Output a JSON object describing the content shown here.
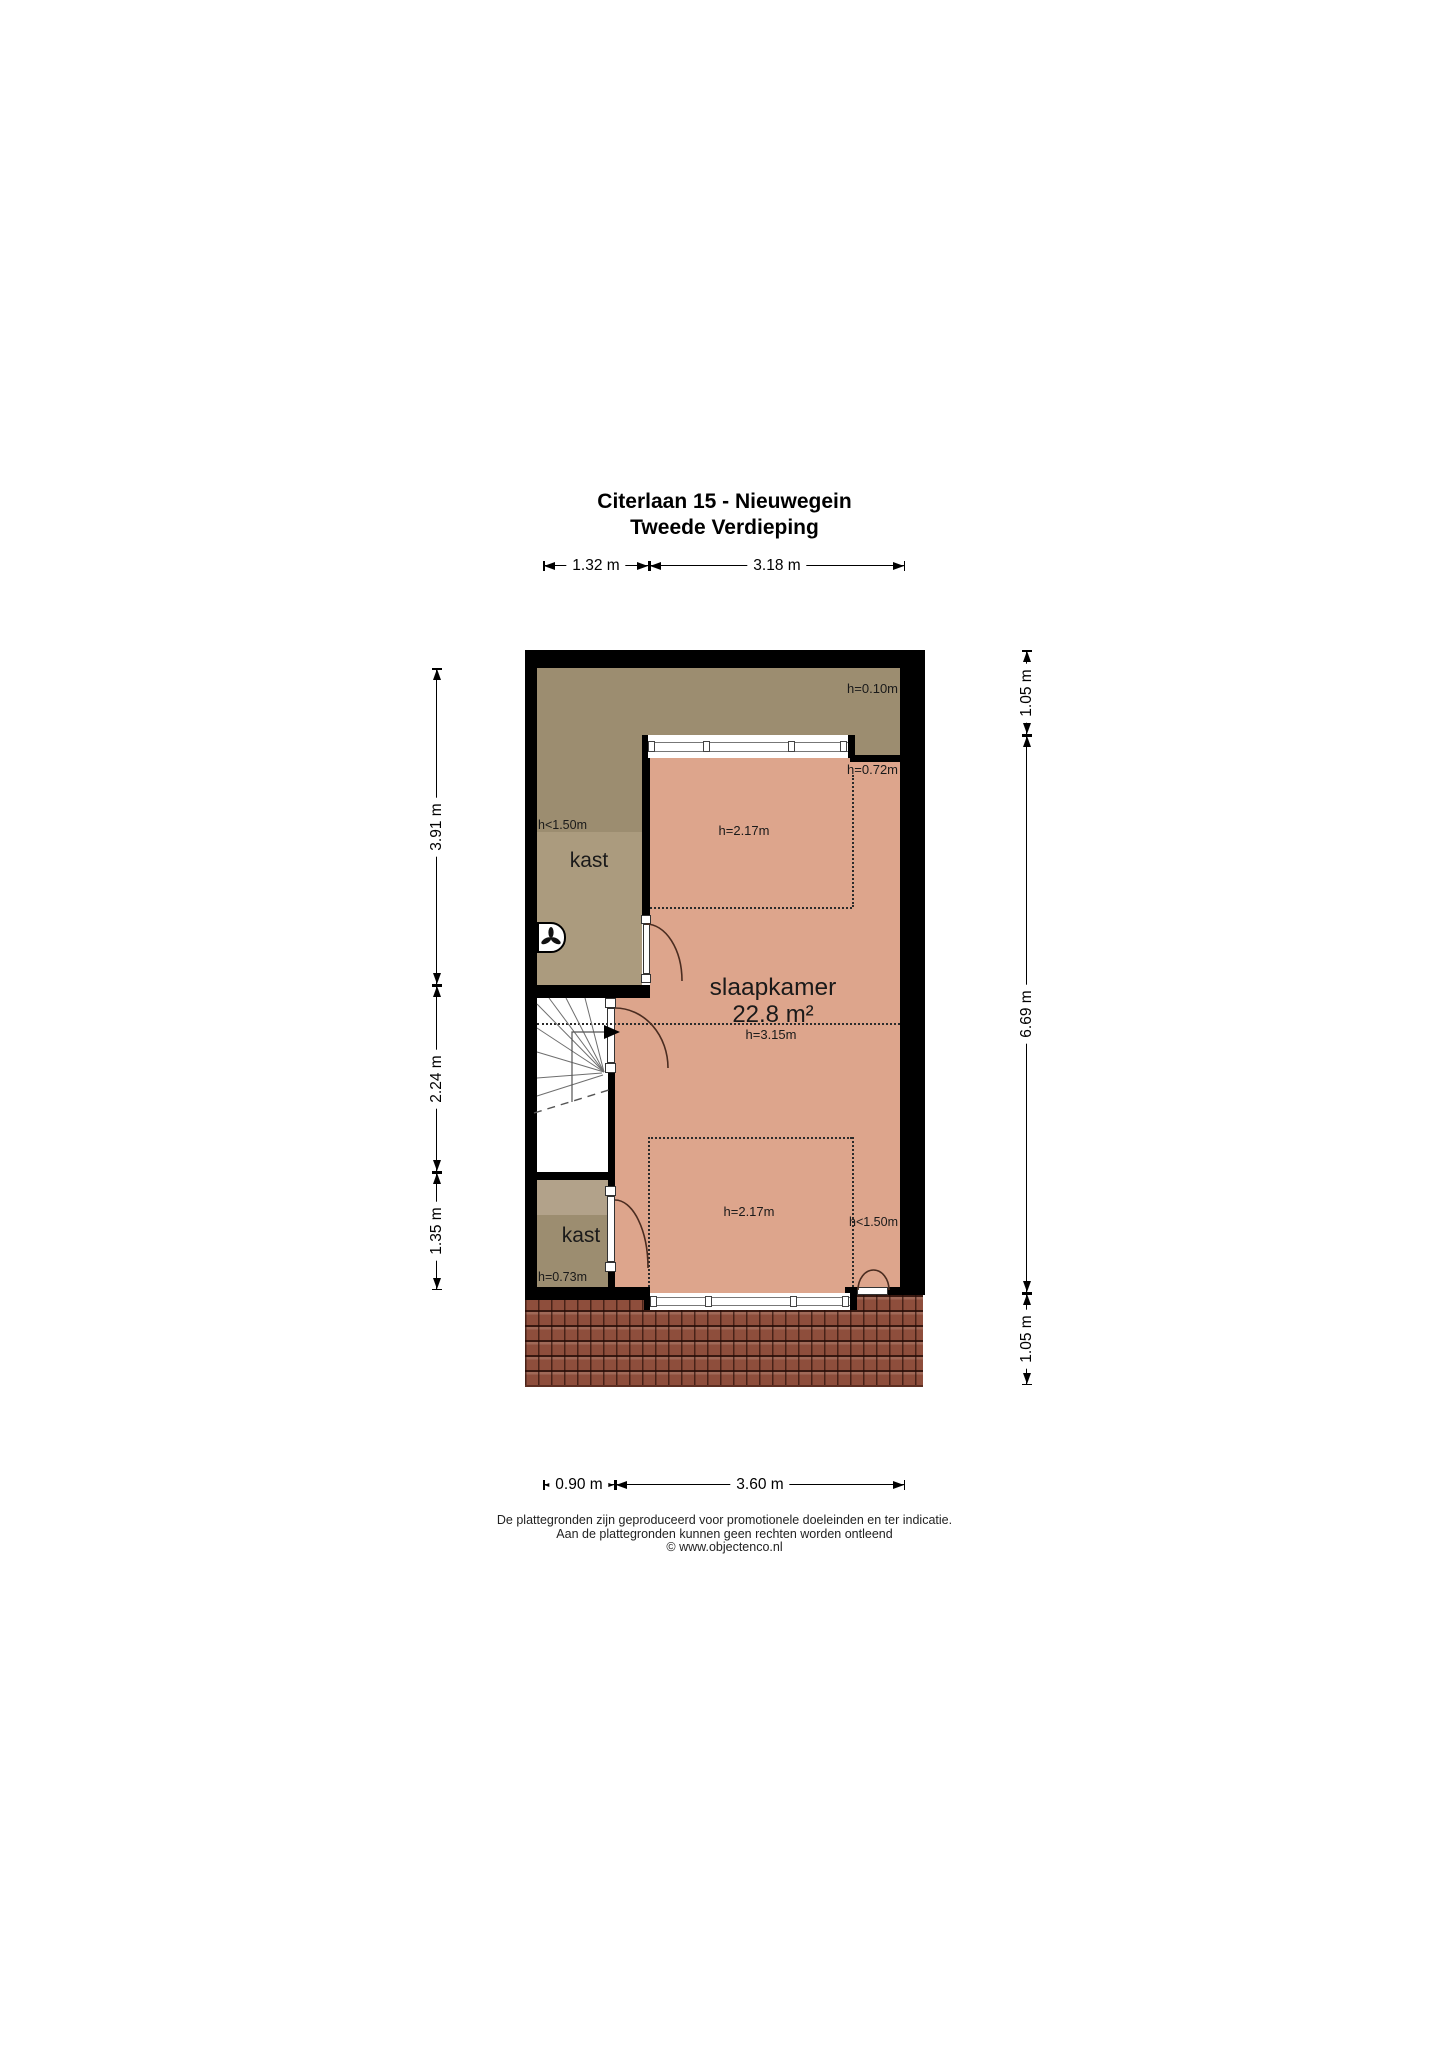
{
  "title": {
    "line1": "Citerlaan 15 - Nieuwegein",
    "line2": "Tweede Verdieping"
  },
  "floor_plan": {
    "rooms": {
      "bedroom": {
        "name": "slaapkamer",
        "area": "22.8 m²",
        "ridge_height": "h=3.15m"
      },
      "closet_top": {
        "name": "kast",
        "height_note": "h<1.50m"
      },
      "closet_bottom": {
        "name": "kast",
        "height_note": "h=0.73m"
      }
    },
    "height_labels": {
      "attic_strip": "h=0.10m",
      "top_right": "h=0.72m",
      "upper_zone": "h=2.17m",
      "lower_zone": "h=2.17m",
      "right_lower": "h<1.50m"
    },
    "dimensions": {
      "top": [
        "1.32 m",
        "3.18 m"
      ],
      "bottom": [
        "0.90 m",
        "3.60 m"
      ],
      "left": [
        "3.91 m",
        "2.24 m",
        "1.35 m"
      ],
      "right": [
        "1.05 m",
        "6.69 m",
        "1.05 m"
      ]
    },
    "colors": {
      "wall": "#000000",
      "closet_fill": "#9C8D70",
      "room_fill": "#DDA58C",
      "roof_fill": "#8E4E3C"
    }
  },
  "footer": {
    "line1": "De plattegronden zijn geproduceerd voor promotionele doeleinden en ter indicatie.",
    "line2": "Aan de plattegronden kunnen geen rechten worden ontleend",
    "line3": "© www.objectenco.nl"
  }
}
